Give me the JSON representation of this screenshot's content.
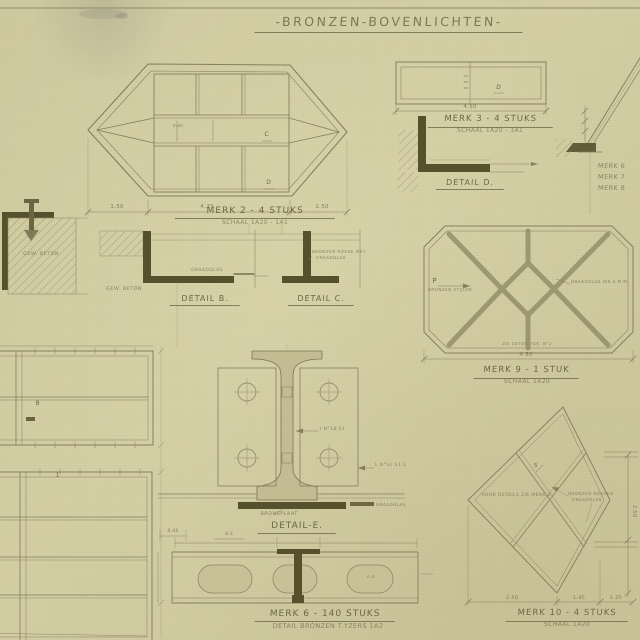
{
  "title": "-BRONZEN-BOVENLICHTEN-",
  "colors": {
    "paper": "#d1cba1",
    "ink": "#857f5e",
    "dark": "#57502d",
    "text": "#6d6748"
  },
  "merk2": {
    "label": "MERK 2 - 4 STUKS",
    "scale": "SCHAAL 1A20 - 1A1",
    "dim_left": "1.50",
    "dim_mid": "4.25",
    "dim_right": "1.50",
    "dim_small": "0.60",
    "mark_c": "C",
    "mark_d": "D"
  },
  "merk3": {
    "label": "MERK 3 - 4 STUKS",
    "scale": "SCHAAL 1A20 - 1A1",
    "dim": "4.50",
    "mark": "D"
  },
  "detail_d": {
    "label": "DETAIL D."
  },
  "corner": {
    "lines": [
      "MERK 6",
      "MERK 7",
      "MERK 8"
    ]
  },
  "beton": {
    "label": "GEW. BETON"
  },
  "detail_b": {
    "label": "DETAIL B.",
    "note_beton": "GEW. BETON",
    "note_glas": "DRAADGLAS"
  },
  "detail_c": {
    "label": "DETAIL C.",
    "note1": "BRONZEN ROEDE MET",
    "note2": "DRAADGLAS"
  },
  "detail_e": {
    "label": "DETAIL-E.",
    "plate": "BRONSPLAAT",
    "beam_note": "I N°18-51",
    "angle_note": "L N°51.51.5",
    "glas_note": "DRAADGLAS",
    "dim1": "0.45",
    "dim2": "4.5"
  },
  "merk6": {
    "label": "MERK 6 - 140 STUKS",
    "sublabel": "DETAIL BRONZEN T.YZERS 1A2",
    "oblong_note": "R.4"
  },
  "merk9": {
    "label": "MERK 9 - 1 STUK",
    "scale": "SCHAAL 1A20",
    "dim": "4.50",
    "mark": "P",
    "note_left": "BRONZEN STIJLEN",
    "note_right": "DRAADGLAS DIK 6 M.M",
    "note_bottom": "ZIE DETAIL TEK. N°2"
  },
  "merk10": {
    "label": "MERK 10 - 4 STUKS",
    "scale": "SCHAAL 1A20",
    "note_center": "VOOR DETAILS ZIE MERK 2",
    "note_right1": "BRONZEN ROEDEN",
    "note_right2": "DRAADGLAS",
    "dim1": "2.50",
    "dim2": "1.45",
    "dim3": "1.25",
    "dim_right": "2.50",
    "mark": "5"
  },
  "plans": {
    "mark_a": "B",
    "mark_b": "1"
  }
}
